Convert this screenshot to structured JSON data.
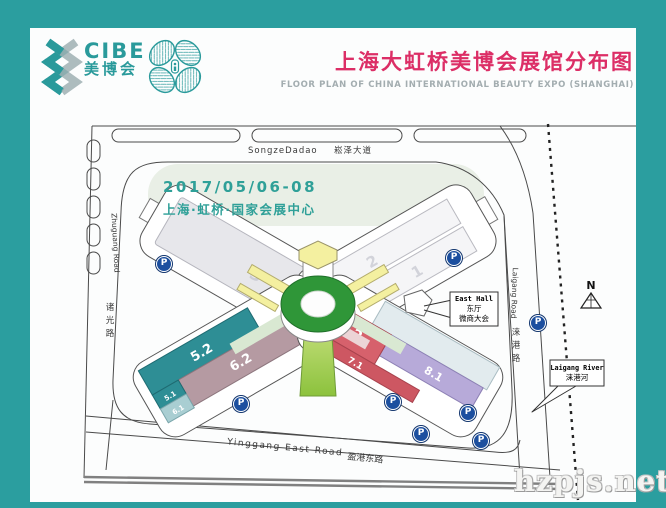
{
  "frame": {
    "border_color": "#2b9e9f"
  },
  "header": {
    "logo": {
      "text": "CIBE",
      "text_cn": "美博会",
      "teal": "#2a9a9b",
      "gray": "#9fb0b3"
    },
    "title_cn": "上海大虹桥美博会展馆分布图",
    "title_color": "#dc2e66",
    "title_en": "FLOOR PLAN OF CHINA INTERNATIONAL BEAUTY EXPO (SHANGHAI)",
    "subtitle_color": "#a3adb0"
  },
  "event": {
    "date": "2017/05/06-08",
    "venue": "上海·虹桥·国家会展中心",
    "color": "#2fa098"
  },
  "map": {
    "roads": {
      "top_en": "SongzeDadao",
      "top_cn": "崧泽大道",
      "left_en": "Zhuguang Road",
      "left_cn_1": "诸",
      "left_cn_2": "光",
      "left_cn_3": "路",
      "right_en": "Laigang Road",
      "right_cn_1": "涞",
      "right_cn_2": "港",
      "right_cn_3": "路",
      "bottom_en": "Yinggang East Road",
      "bottom_cn": "盈港东路"
    },
    "river": {
      "en": "Laigang River",
      "cn": "涞港河"
    },
    "east_hall": {
      "line1": "East Hall",
      "line2": "东厅",
      "line3": "微商大会"
    },
    "compass": "N",
    "halls": {
      "h1": {
        "label": "1",
        "color": "#f5f5f7"
      },
      "h2": {
        "label": "2",
        "color": "#f5f5f7"
      },
      "h3": {
        "label": "3",
        "color": "#e7e7eb"
      },
      "h51": {
        "label": "5.1",
        "color": "#2e8e95"
      },
      "h52": {
        "label": "5.2",
        "color": "#2e8e95"
      },
      "h61": {
        "label": "6.1",
        "color": "#a9ced2"
      },
      "h62": {
        "label": "6.2",
        "color": "#b59aa2"
      },
      "h71": {
        "label": "7.1",
        "color": "#cd5762"
      },
      "h72": {
        "label": "7.2",
        "color": "#d6616c"
      },
      "h81": {
        "label": "8.1",
        "color": "#b7aad9"
      },
      "glass_color": "#e2ebee"
    },
    "parking": {
      "label": "P",
      "color": "#1c4f9f",
      "spots": [
        {
          "x": 163,
          "y": 263
        },
        {
          "x": 453,
          "y": 257
        },
        {
          "x": 240,
          "y": 403
        },
        {
          "x": 392,
          "y": 401
        },
        {
          "x": 467,
          "y": 412
        },
        {
          "x": 420,
          "y": 433
        },
        {
          "x": 480,
          "y": 440
        },
        {
          "x": 537,
          "y": 322
        }
      ]
    }
  },
  "watermark": "hzpjs.net"
}
